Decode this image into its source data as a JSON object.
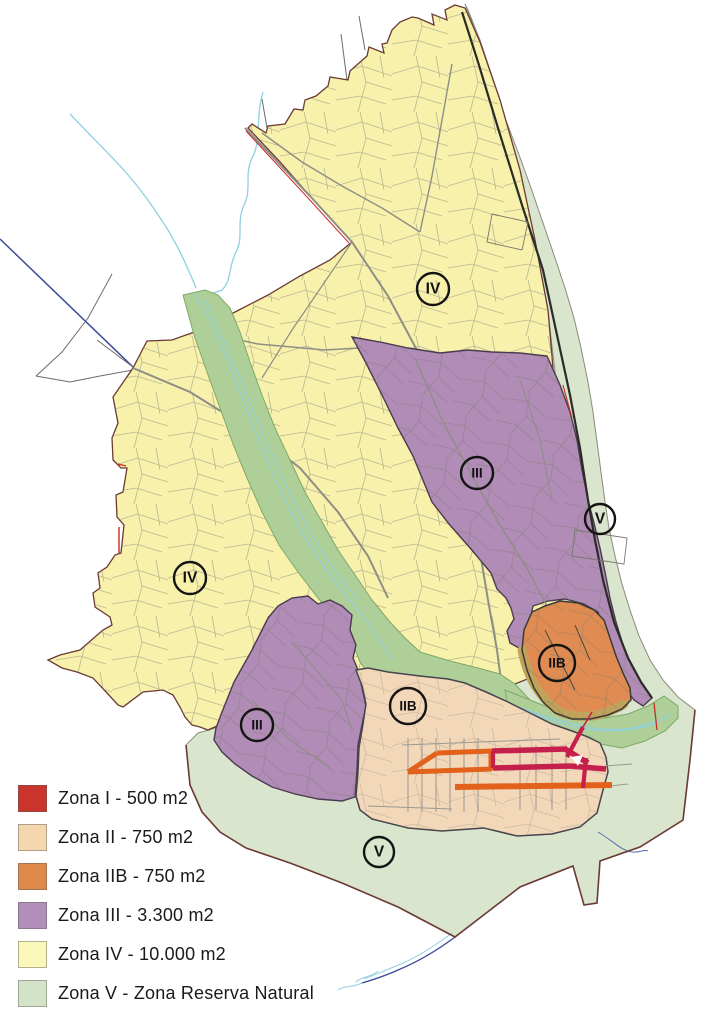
{
  "map": {
    "title": "Municipal zoning map",
    "palette": {
      "zona_iv": "#F7F1AB",
      "zona_v": "#D9E5CC",
      "river_corridor": "#AFCF99",
      "zona_iii": "#B18CB6",
      "zona_ii": "#F3D7B9",
      "zona_iib": "#DF8B51",
      "shadow_tan": "#BFA35B",
      "street_zona_i": "#C51F4B",
      "street_zona_iib": "#E2621C",
      "boundary": "#6B3A34",
      "coast_line": "#2B2B28",
      "parcel_line": "#85857C",
      "road_line": "#8E8E85",
      "stream_cyan": "#8FD0E0",
      "stream_navy": "#3C4C9A",
      "red_road": "#CB2B20",
      "zone_edge_dark": "#45454E",
      "purple_edge": "#4A3A50",
      "corridor_edge": "#7FA868",
      "orange_edge": "#3A3A35"
    },
    "region_labels": [
      {
        "id": "iv-north",
        "text": "IV",
        "x": 433,
        "y": 289,
        "r": 16
      },
      {
        "id": "iv-west",
        "text": "IV",
        "x": 190,
        "y": 578,
        "r": 16
      },
      {
        "id": "iii-east",
        "text": "III",
        "x": 477,
        "y": 473,
        "r": 16
      },
      {
        "id": "iii-southwest",
        "text": "III",
        "x": 257,
        "y": 725,
        "r": 16
      },
      {
        "id": "v-coast",
        "text": "V",
        "x": 600,
        "y": 519,
        "r": 15
      },
      {
        "id": "v-south",
        "text": "V",
        "x": 379,
        "y": 852,
        "r": 15
      },
      {
        "id": "iib-orange",
        "text": "IIB",
        "x": 557,
        "y": 663,
        "r": 18
      },
      {
        "id": "iib-west",
        "text": "IIB",
        "x": 408,
        "y": 706,
        "r": 18
      }
    ]
  },
  "legend": {
    "items": [
      {
        "id": "zona-i",
        "label": "Zona I - 500 m2",
        "color": "#C9342C"
      },
      {
        "id": "zona-ii",
        "label": "Zona II - 750 m2",
        "color": "#F4D7AE"
      },
      {
        "id": "zona-iib",
        "label": "Zona IIB - 750 m2",
        "color": "#DF8A4D"
      },
      {
        "id": "zona-iii",
        "label": "Zona III - 3.300 m2",
        "color": "#B28FB8"
      },
      {
        "id": "zona-iv",
        "label": "Zona IV - 10.000 m2",
        "color": "#FAF7B9"
      },
      {
        "id": "zona-v",
        "label": "Zona V - Zona Reserva Natural",
        "color": "#D3E3C8"
      }
    ]
  }
}
